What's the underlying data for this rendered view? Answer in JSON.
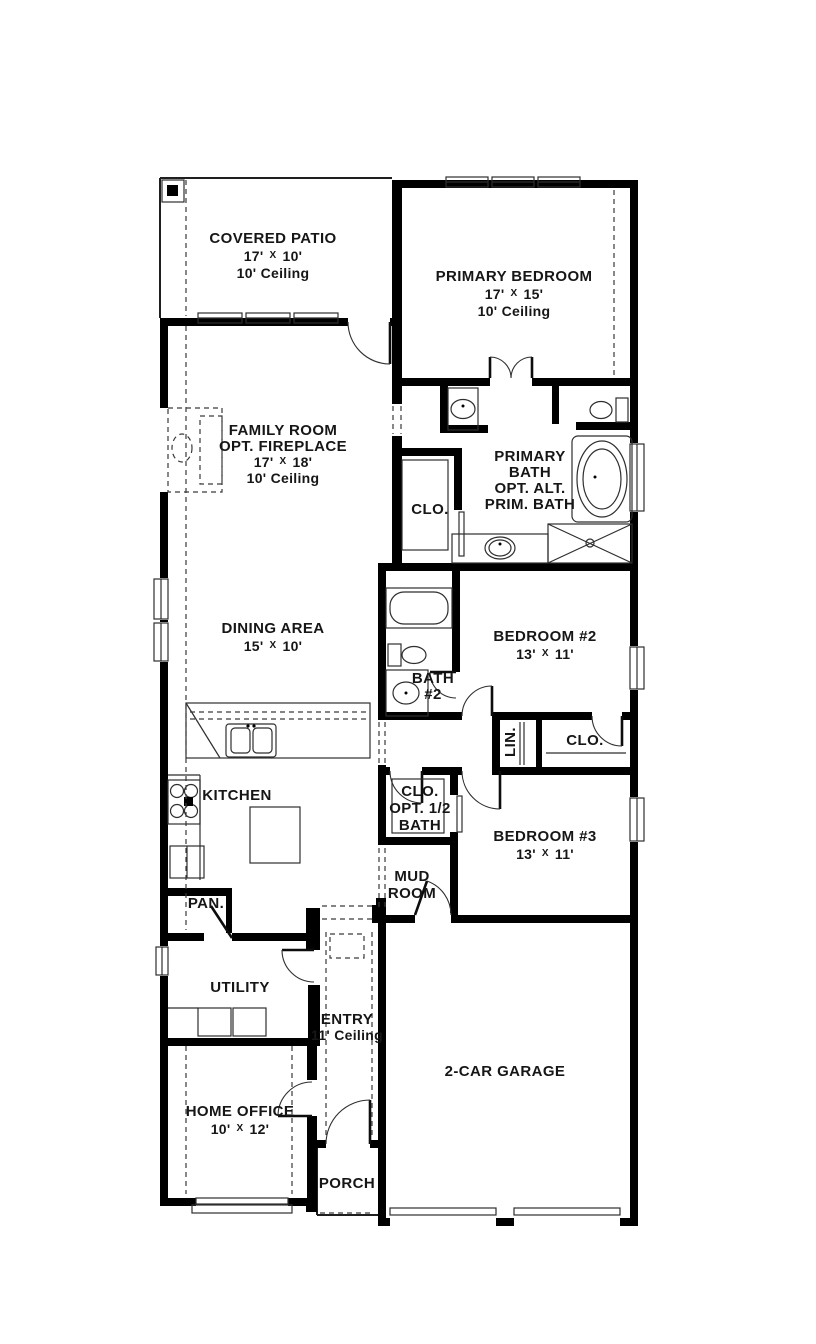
{
  "colors": {
    "wall": "#000000",
    "line": "#2e2e2e",
    "dashed_line": "#3a3a3a",
    "background": "#ffffff",
    "text": "#161616"
  },
  "rooms": {
    "covered_patio": {
      "name": "COVERED PATIO",
      "dim_w": "17'",
      "dim_x": "X",
      "dim_h": "10'",
      "ceiling": "10' Ceiling"
    },
    "primary_bedroom": {
      "name": "PRIMARY BEDROOM",
      "dim_w": "17'",
      "dim_x": "X",
      "dim_h": "15'",
      "ceiling": "10' Ceiling"
    },
    "family_room": {
      "name": "FAMILY ROOM",
      "option": "OPT. FIREPLACE",
      "dim_w": "17'",
      "dim_x": "X",
      "dim_h": "18'",
      "ceiling": "10' Ceiling"
    },
    "primary_bath": {
      "line1": "PRIMARY",
      "line2": "BATH",
      "line3": "OPT. ALT.",
      "line4": "PRIM. BATH"
    },
    "primary_closet": {
      "name": "CLO."
    },
    "dining_area": {
      "name": "DINING AREA",
      "dim_w": "15'",
      "dim_x": "X",
      "dim_h": "10'"
    },
    "bath_2": {
      "line1": "BATH",
      "line2": "#2"
    },
    "bedroom_2": {
      "name": "BEDROOM #2",
      "dim_w": "13'",
      "dim_x": "X",
      "dim_h": "11'"
    },
    "linen": {
      "name": "LIN."
    },
    "closet_2": {
      "name": "CLO."
    },
    "kitchen": {
      "name": "KITCHEN"
    },
    "pantry": {
      "name": "PAN."
    },
    "closet_opt_half_bath": {
      "line1": "CLO.",
      "line2": "OPT. 1/2",
      "line3": "BATH"
    },
    "mud_room": {
      "line1": "MUD",
      "line2": "ROOM"
    },
    "bedroom_3": {
      "name": "BEDROOM #3",
      "dim_w": "13'",
      "dim_x": "X",
      "dim_h": "11'"
    },
    "utility": {
      "name": "UTILITY"
    },
    "entry": {
      "name": "ENTRY",
      "ceiling": "11' Ceiling"
    },
    "home_office": {
      "name": "HOME OFFICE",
      "dim_w": "10'",
      "dim_x": "X",
      "dim_h": "12'"
    },
    "garage": {
      "name": "2-CAR GARAGE"
    },
    "porch": {
      "name": "PORCH"
    }
  },
  "fixtures": [
    "corner-post",
    "window",
    "door-swing",
    "double-door",
    "garage-door",
    "fireplace-opt",
    "garden-tub",
    "bathtub",
    "shower",
    "toilet",
    "sink",
    "kitchen-double-sink",
    "stove",
    "refrigerator",
    "kitchen-island",
    "washer-dryer",
    "closet-shelf"
  ]
}
